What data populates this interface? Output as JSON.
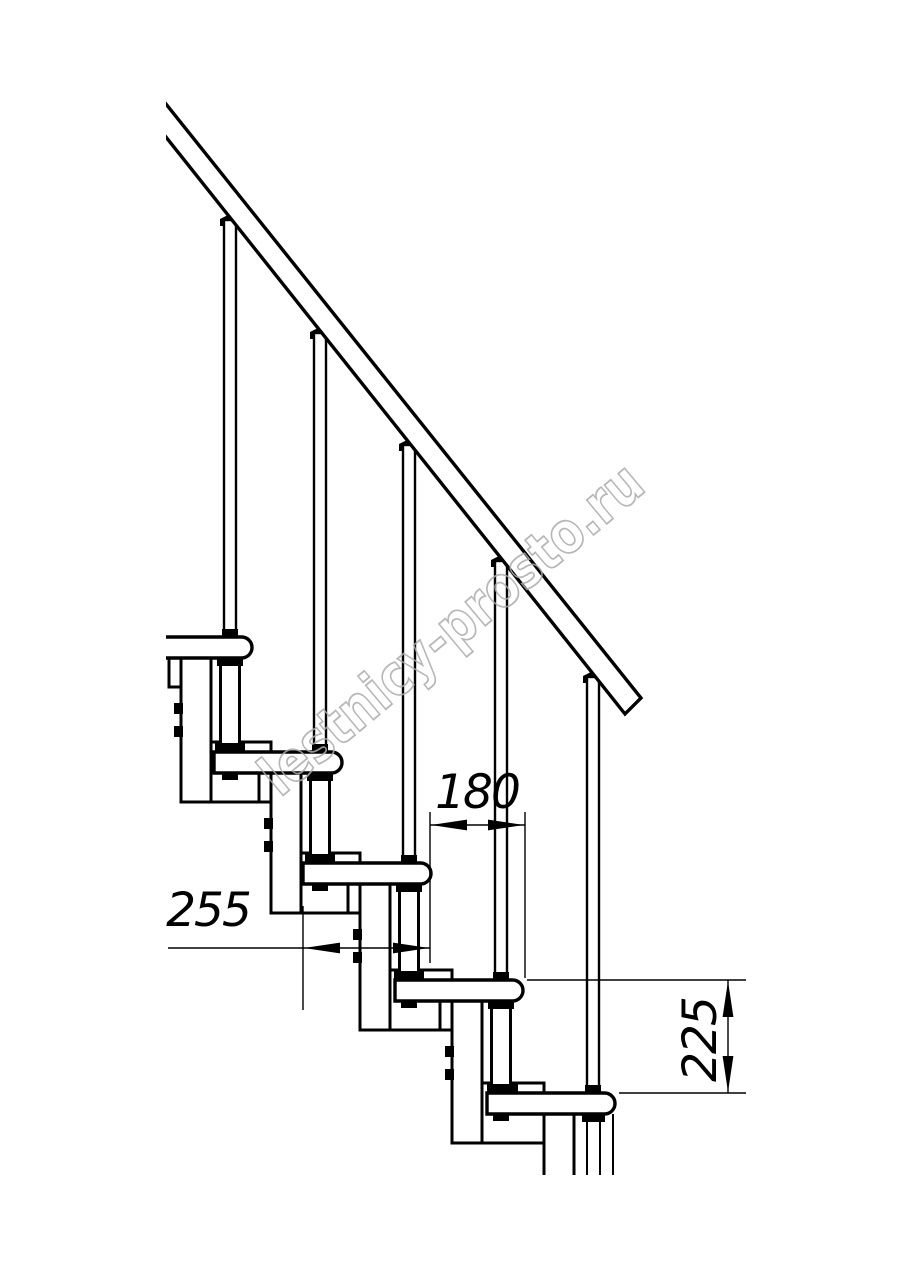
{
  "page": {
    "background_color": "#ffffff",
    "line_color": "#000000"
  },
  "watermark": {
    "text": "lestnicy-prosto.ru",
    "color": "#ababab"
  },
  "dimensions": {
    "tread_depth": {
      "value": "255"
    },
    "step_run": {
      "value": "180"
    },
    "step_rise": {
      "value": "225"
    }
  },
  "drawing": {
    "visible_steps": 5,
    "visible_balusters": 5
  }
}
